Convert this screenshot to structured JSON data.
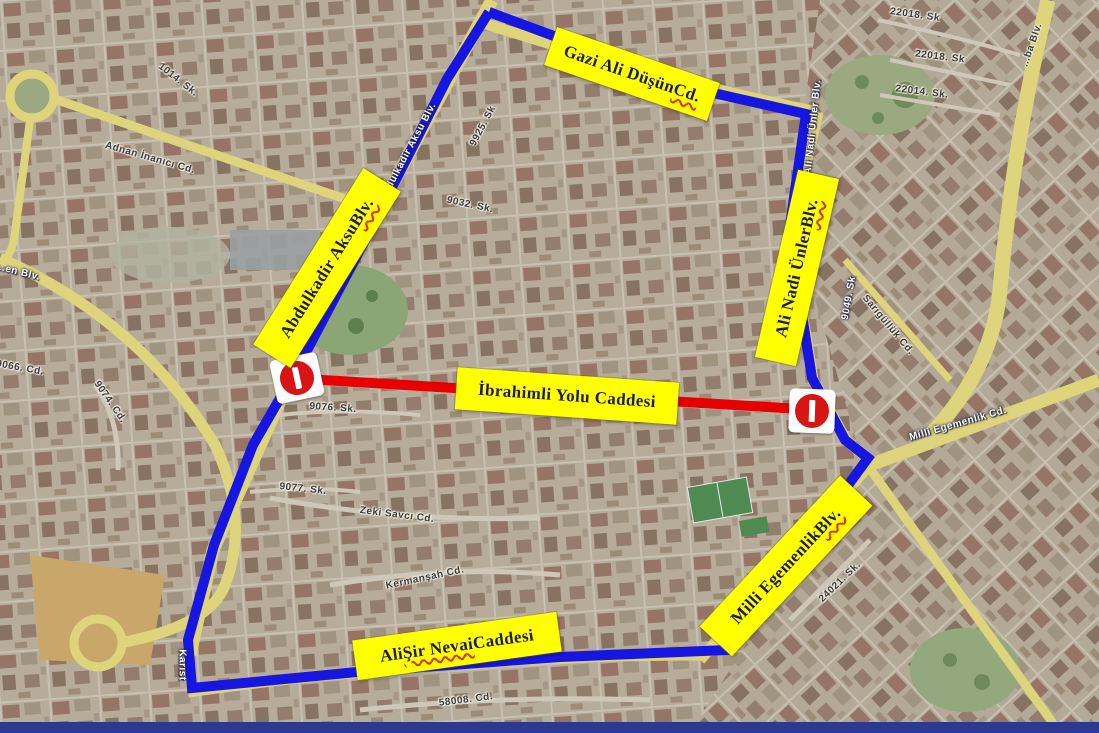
{
  "map": {
    "colors": {
      "route_outline": "#1616e0",
      "closed_road": "#e60000",
      "label_plate": "#ffff00",
      "label_text": "#1c1c55",
      "squiggle": "#e03000"
    },
    "route_labels": [
      {
        "pre": "Gazi Ali Düşün ",
        "wavy": "Cd.",
        "post": ""
      },
      {
        "pre": "Abdulkadir Aksu ",
        "wavy": "Blv.",
        "post": ""
      },
      {
        "pre": "Ali Nadi Ünler ",
        "wavy": "Blv.",
        "post": ""
      },
      {
        "pre": "İbrahimli Yolu Caddesi",
        "wavy": "",
        "post": ""
      },
      {
        "pre": "Milli Egemenlik ",
        "wavy": "Blv.",
        "post": ""
      },
      {
        "pre": "Ali ",
        "wavy": "Şir Nevai",
        "post": " Caddesi"
      }
    ],
    "signs": [
      {
        "name": "no-entry-left"
      },
      {
        "name": "no-entry-right"
      }
    ],
    "street_labels": [
      {
        "text": "Adnan İnanıcı Cd."
      },
      {
        "text": "1014. Sk."
      },
      {
        "text": "Abdulkadir Aksu Blv."
      },
      {
        "text": "9925. Sk"
      },
      {
        "text": "9032. Sk."
      },
      {
        "text": "9076. Sk."
      },
      {
        "text": "9077. Sk."
      },
      {
        "text": "Zeki Savcı Cd."
      },
      {
        "text": "Kermanşah Cd."
      },
      {
        "text": "58008. Cd."
      },
      {
        "text": "Karıst"
      },
      {
        "text": "Ali Nadi Ünler Blv."
      },
      {
        "text": "22018. Sk"
      },
      {
        "text": "22018. Sk"
      },
      {
        "text": "22014. Sk."
      },
      {
        "text": "...ba Blv."
      },
      {
        "text": "Sarıgüllük Cd."
      },
      {
        "text": "9049. Sk"
      },
      {
        "text": "Milli Egemenlik Cd."
      },
      {
        "text": "24021. Sk."
      },
      {
        "text": "...en Blv."
      },
      {
        "text": "9066. Cd."
      },
      {
        "text": "9074. Cd."
      }
    ]
  }
}
